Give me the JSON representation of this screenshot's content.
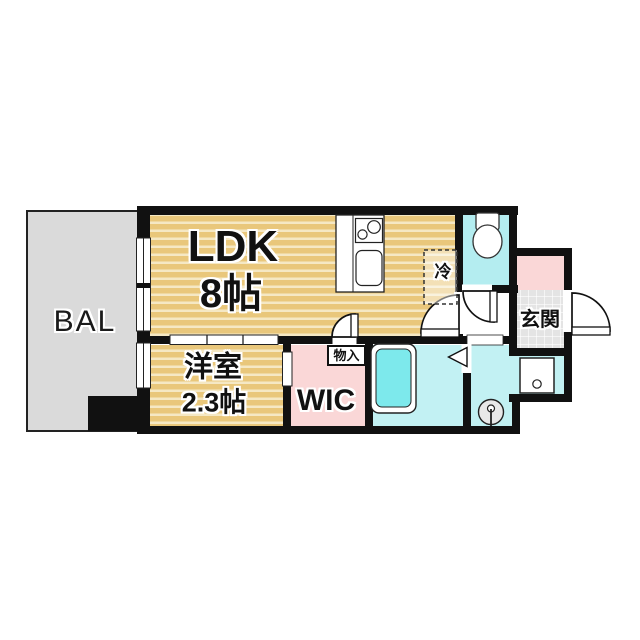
{
  "rooms": {
    "balcony": {
      "label": "BAL"
    },
    "ldk": {
      "name": "LDK",
      "size": "8帖"
    },
    "bedroom": {
      "name": "洋室",
      "size": "2.3帖"
    },
    "wic": {
      "label": "WIC"
    },
    "storage": {
      "label": "物入"
    },
    "refrigerator": {
      "label": "冷"
    },
    "entrance": {
      "label": "玄関"
    }
  },
  "colors": {
    "wall": "#111111",
    "wood-base": "#e9c77b",
    "wood-stripe": "#f5e8c4",
    "balcony-gray": "#dadada",
    "pink": "#fad7d7",
    "cyan-room": "#c2f1f3",
    "cyan-toilet": "#b4edf0",
    "tub-cyan": "#7de9ec",
    "tile-gray": "#e4e4e4",
    "outline": "#222222"
  }
}
